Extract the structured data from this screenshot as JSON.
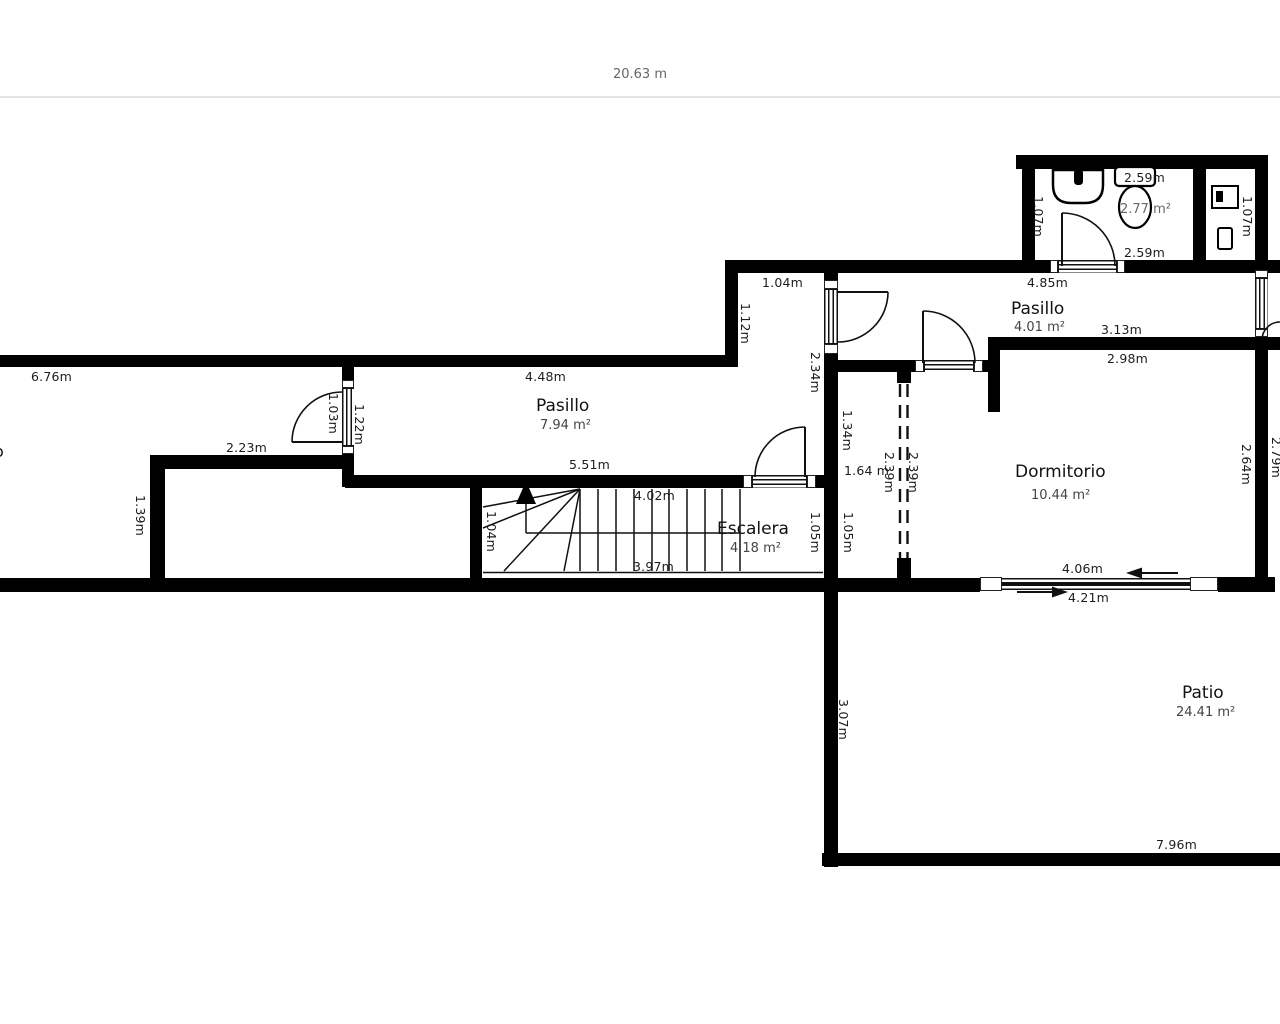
{
  "scale_ruler": {
    "label": "20.63 m"
  },
  "rooms": {
    "cutoff_left": {
      "name_fragment": "o"
    },
    "pasillo_main": {
      "name": "Pasillo",
      "area": "7.94 m²"
    },
    "escalera": {
      "name": "Escalera",
      "area": "4.18 m²"
    },
    "pasillo_upper_right": {
      "name": "Pasillo",
      "area": "4.01 m²"
    },
    "dormitorio": {
      "name": "Dormitorio",
      "area": "10.44 m²"
    },
    "patio": {
      "name": "Patio",
      "area": "24.41 m²"
    },
    "bathroom": {
      "area": "2.77 m²"
    }
  },
  "dimensions": {
    "left_room_top_width": "6.76m",
    "left_room_inner_width": "2.23m",
    "left_room_wall_height": "1.39m",
    "left_room_door": "1.03m",
    "pasillo_left_wall": "1.22m",
    "pasillo_top_width": "4.48m",
    "pasillo_bottom_width": "5.51m",
    "nook_width": "1.04m",
    "nook_left_height": "1.12m",
    "nook_right_height": "2.34m",
    "stairs_top_width": "4.02m",
    "stairs_bottom_width": "3.97m",
    "stairs_left_height": "1.04m",
    "escalera_right_height": "1.05m",
    "hall_upper_height": "1.34m",
    "hall_width": "1.64 m",
    "hall_lower_height": "1.05m",
    "hall_dashed_left": "2.39m",
    "hall_dashed_right": "2.39m",
    "upper_pasillo_width": "4.85m",
    "upper_pasillo_inner_width": "3.13m",
    "dormitorio_top_width": "2.98m",
    "dormitorio_right_height": "2.64m",
    "outer_right_height": "2.79m",
    "dormitorio_window_width": "4.06m",
    "dormitorio_window_outer_width": "4.21m",
    "patio_left_height": "3.07m",
    "patio_bottom_width": "7.96m",
    "bathroom_top_width": "2.59m",
    "bathroom_bottom_width": "2.59m",
    "bathroom_left_height": "1.07m",
    "bathroom_right_height": "1.07m"
  }
}
